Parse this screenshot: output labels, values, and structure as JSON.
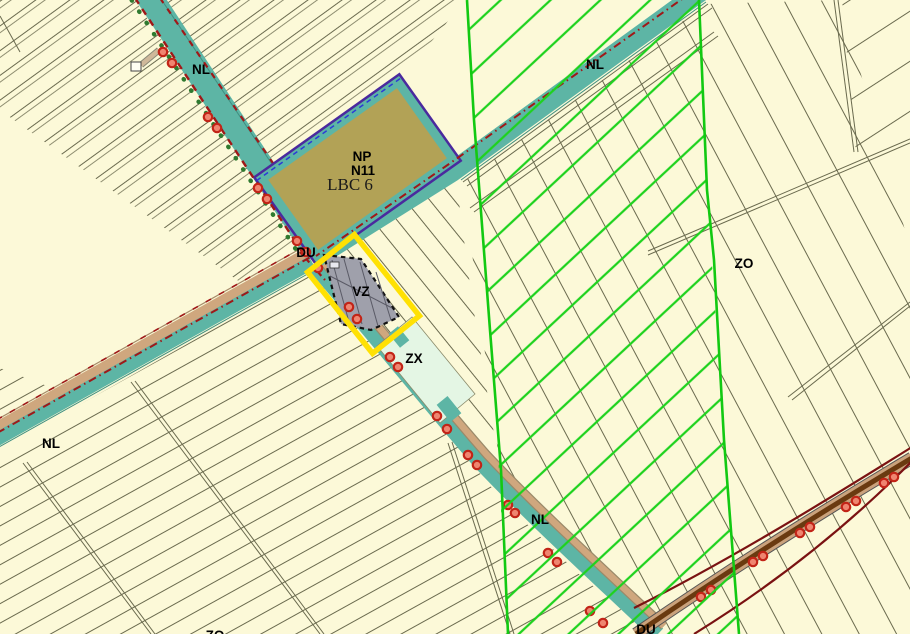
{
  "map": {
    "type": "zoning-plan-map",
    "labels": [
      {
        "id": "nl-top-left",
        "text": "NL",
        "x": 201,
        "y": 74
      },
      {
        "id": "nl-top-right",
        "text": "NL",
        "x": 595,
        "y": 69
      },
      {
        "id": "np",
        "text": "NP",
        "x": 362,
        "y": 161
      },
      {
        "id": "n11",
        "text": "N11",
        "x": 363,
        "y": 175
      },
      {
        "id": "lbc-6",
        "text": "LBC 6",
        "x": 350,
        "y": 188
      },
      {
        "id": "du-central",
        "text": "DU",
        "x": 306,
        "y": 257
      },
      {
        "id": "vz",
        "text": "VZ",
        "x": 361,
        "y": 296
      },
      {
        "id": "zx",
        "text": "ZX",
        "x": 414,
        "y": 363
      },
      {
        "id": "zo-east",
        "text": "ZO",
        "x": 744,
        "y": 268
      },
      {
        "id": "nl-west",
        "text": "NL",
        "x": 51,
        "y": 448
      },
      {
        "id": "nl-south",
        "text": "NL",
        "x": 540,
        "y": 524
      },
      {
        "id": "zo-south",
        "text": "ZO",
        "x": 215,
        "y": 640
      },
      {
        "id": "du-south",
        "text": "DU",
        "x": 646,
        "y": 634
      }
    ],
    "colors": {
      "background": "#fcf9d8",
      "canal_teal": "#5db5a5",
      "zone_olive": "#b2a256",
      "zone_mint": "#e4f6e4",
      "building_gray": "#9fa0ab",
      "highlight_yellow": "#ffe103",
      "hatch_green": "#1ed21e",
      "boundary_green": "#12c912",
      "deco_red": "#a01818",
      "road_tan": "#cfa77e",
      "road_brown": "#6a3a10",
      "maroon_line": "#7a1212",
      "purple_outline": "#4a2a9e",
      "parcel_line": "#6a6a4e",
      "marker_ring": "#c22417",
      "marker_fill": "#ef8570",
      "dot_green": "#2f7a2f",
      "label_black": "#000000"
    }
  }
}
